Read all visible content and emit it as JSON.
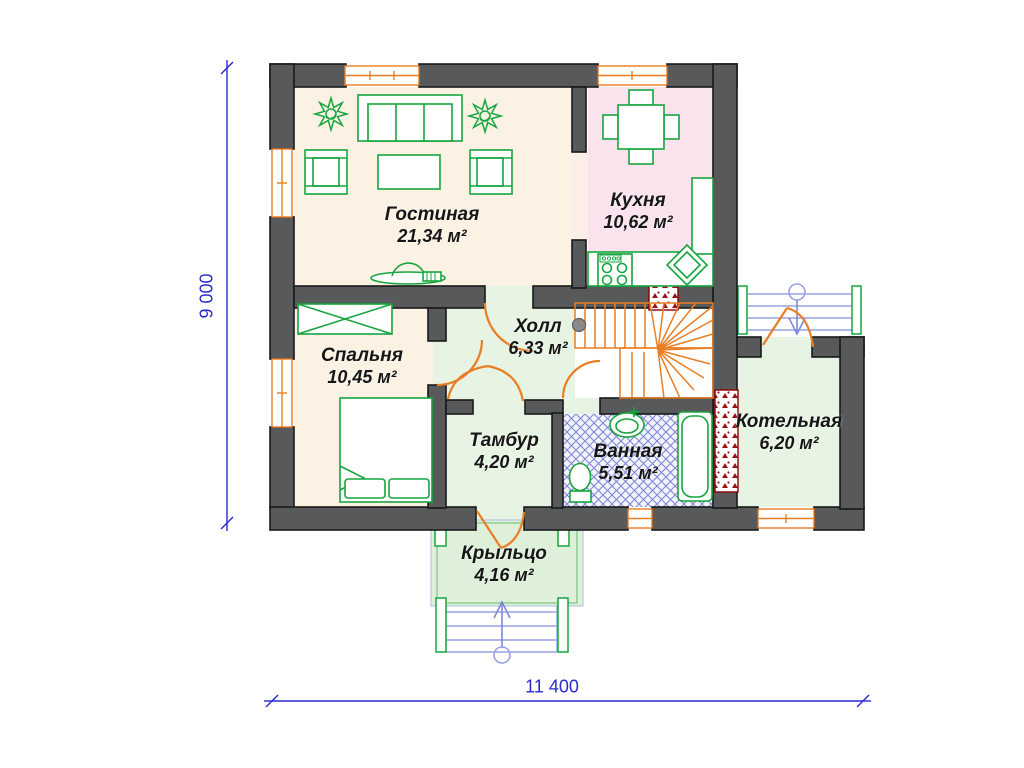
{
  "title": "Floor plan — first floor",
  "rooms": [
    {
      "id": "living",
      "name": "Гостиная",
      "area": "21,34 м²"
    },
    {
      "id": "kitchen",
      "name": "Кухня",
      "area": "10,62 м²"
    },
    {
      "id": "bedroom",
      "name": "Спальня",
      "area": "10,45 м²"
    },
    {
      "id": "hall",
      "name": "Холл",
      "area": "6,33 м²"
    },
    {
      "id": "tambour",
      "name": "Тамбур",
      "area": "4,20 м²"
    },
    {
      "id": "bathroom",
      "name": "Ванная",
      "area": "5,51 м²"
    },
    {
      "id": "boiler",
      "name": "Котельная",
      "area": "6,20 м²"
    },
    {
      "id": "porch",
      "name": "Крыльцо",
      "area": "4,16 м²"
    }
  ],
  "dimensions": {
    "height_mm": "9 000",
    "width_mm": "11 400"
  },
  "colors": {
    "wall": "#58595b",
    "door_window_accent": "#e97e23",
    "furniture": "#16a53f",
    "dimension": "#2a2ad0",
    "floor_cream": "#fcf2e4",
    "floor_pink": "#fae3ec",
    "floor_green": "#e7f4e3",
    "bath_hatch": "#7b84d6",
    "chimney_hatch": "#9c1313"
  },
  "icons": [
    "sofa-icon",
    "armchair-icon",
    "coffee-table-icon",
    "plant-icon",
    "tv-icon",
    "dining-table-icon",
    "stove-icon",
    "kitchen-sink-icon",
    "wardrobe-icon",
    "bed-icon",
    "bath-sink-icon",
    "toilet-icon",
    "bathtub-icon",
    "staircase-icon",
    "steps-arrow-icon"
  ]
}
